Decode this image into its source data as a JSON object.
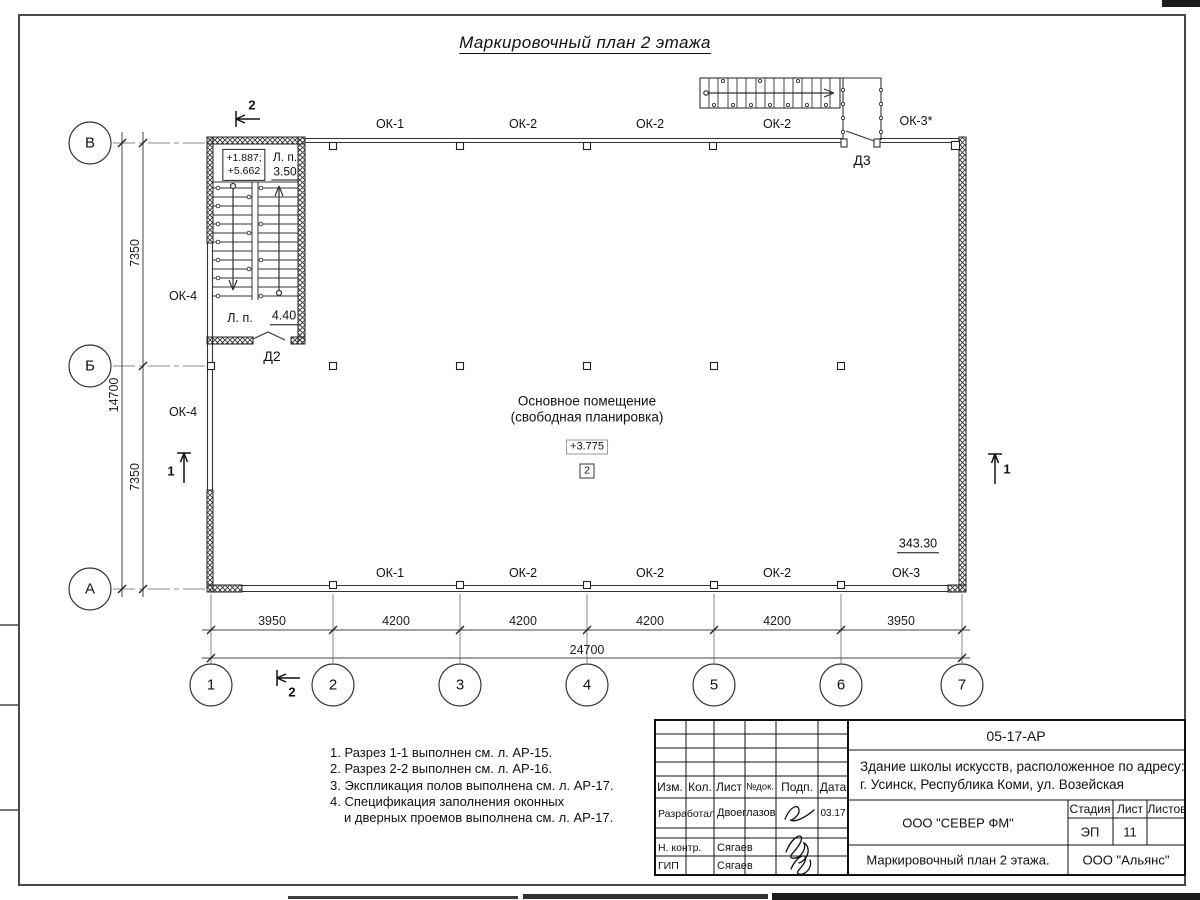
{
  "title": "Маркировочный план 2 этажа",
  "plan": {
    "windows_top": [
      "ОК-1",
      "ОК-2",
      "ОК-2",
      "ОК-2"
    ],
    "window_top_right": "ОК-3*",
    "windows_bottom": [
      "ОК-1",
      "ОК-2",
      "ОК-2",
      "ОК-2",
      "ОК-3"
    ],
    "windows_left": [
      "ОК-4",
      "ОК-4"
    ],
    "door_left": "Д2",
    "door_top": "Д3",
    "room_name_line1": "Основное помещение",
    "room_name_line2": "(свободная планировка)",
    "room_elevation": "+3.775",
    "room_number": "2",
    "room_area": "343.30",
    "stair": {
      "elev_line1": "+1.887;",
      "elev_line2": "+5.662",
      "landing_label_upper": "Л. п.",
      "landing_value_upper": "3.50",
      "landing_label_lower": "Л. п.",
      "landing_value_lower": "4.40"
    },
    "section_marks": {
      "s1": "1",
      "s2": "2"
    }
  },
  "axes": {
    "rows": [
      "В",
      "Б",
      "А"
    ],
    "cols": [
      "1",
      "2",
      "3",
      "4",
      "5",
      "6",
      "7"
    ]
  },
  "dimensions": {
    "bottom_segments": [
      "3950",
      "4200",
      "4200",
      "4200",
      "4200",
      "3950"
    ],
    "bottom_total": "24700",
    "left_segments": [
      "7350",
      "7350"
    ],
    "left_total": "14700"
  },
  "notes": {
    "line1": "1. Разрез 1-1 выполнен см. л. АР-15.",
    "line2": "2. Разрез 2-2 выполнен см. л. АР-16.",
    "line3": "3. Экспликация полов выполнена см. л. АР-17.",
    "line4": "4. Спецификация заполнения оконных",
    "line5": "и дверных проемов выполнена см. л. АР-17."
  },
  "titleblock": {
    "doc_code": "05-17-АР",
    "project_line1": "Здание школы искусств, расположенное по адресу:",
    "project_line2": "г. Усинск, Республика Коми, ул. Возейская",
    "col_izm": "Изм.",
    "col_kol": "Кол.",
    "col_list": "Лист",
    "col_ndok": "№док.",
    "col_podp": "Подп.",
    "col_data": "Дата",
    "row1_role": "Разработал",
    "row1_name": "Двоеглазов",
    "row1_date": "03.17",
    "row2_role": "Н. контр.",
    "row2_name": "Сягаев",
    "row3_role": "ГИП",
    "row3_name": "Сягаев",
    "org_top": "ООО \"СЕВЕР ФМ\"",
    "stage_label": "Стадия",
    "sheet_label": "Лист",
    "sheets_label": "Листов",
    "stage_value": "ЭП",
    "sheet_value": "11",
    "drawing_title": "Маркировочный план 2 этажа.",
    "org_bottom": "ООО \"Альянс\""
  }
}
